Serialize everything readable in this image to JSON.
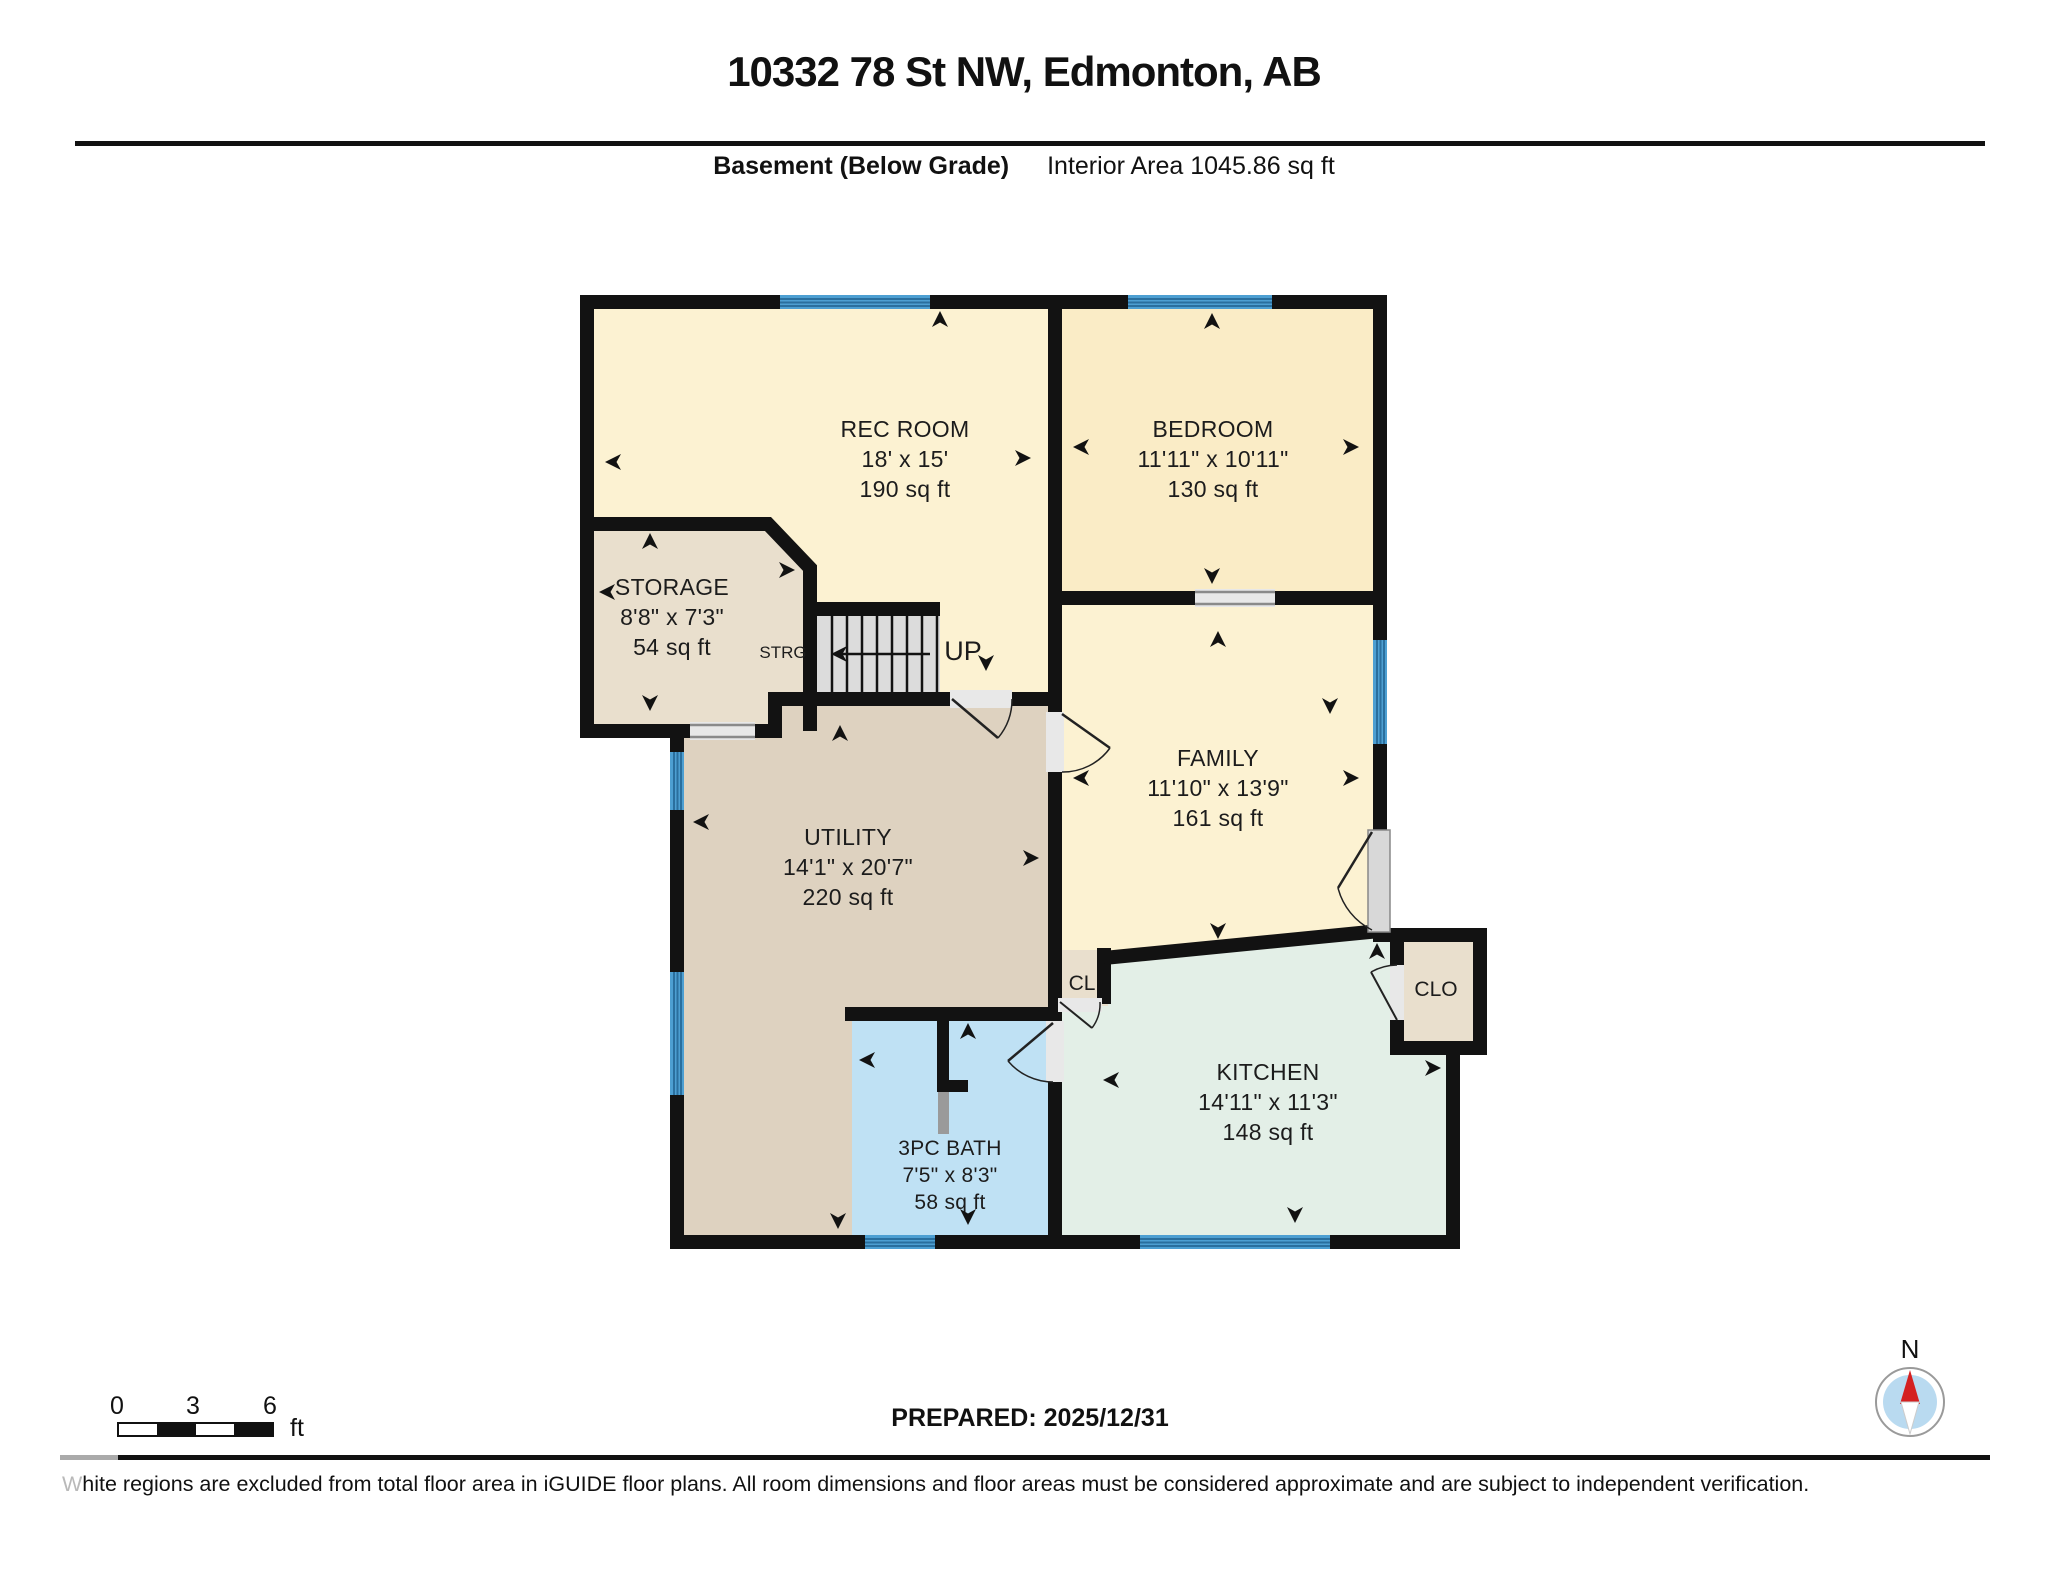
{
  "header": {
    "title": "10332 78 St NW, Edmonton, AB",
    "floor_label": "Basement (Below Grade)",
    "area_label": "Interior Area 1045.86 sq ft"
  },
  "rooms": {
    "rec": {
      "name": "REC ROOM",
      "dims": "18' x 15'",
      "area": "190 sq ft"
    },
    "bedroom": {
      "name": "BEDROOM",
      "dims": "11'11\" x 10'11\"",
      "area": "130 sq ft"
    },
    "storage": {
      "name": "STORAGE",
      "dims": "8'8\" x 7'3\"",
      "area": "54 sq ft"
    },
    "family": {
      "name": "FAMILY",
      "dims": "11'10\" x 13'9\"",
      "area": "161 sq ft"
    },
    "utility": {
      "name": "UTILITY",
      "dims": "14'1\" x 20'7\"",
      "area": "220 sq ft"
    },
    "bath": {
      "name": "3PC BATH",
      "dims": "7'5\" x 8'3\"",
      "area": "58 sq ft"
    },
    "kitchen": {
      "name": "KITCHEN",
      "dims": "14'11\" x 11'3\"",
      "area": "148 sq ft"
    },
    "closet_cl": "CL",
    "closet_clo": "CLO",
    "strg": "STRG",
    "stairs_up": "UP"
  },
  "scale_bar": {
    "labels": [
      "0",
      "3",
      "6"
    ],
    "unit": "ft"
  },
  "footer": {
    "prepared": "PREPARED: 2025/12/31",
    "disclaimer_w": "W",
    "disclaimer_rest": "hite regions are excluded from total floor area in iGUIDE floor plans. All room dimensions and floor areas must be considered approximate and are subject to independent verification."
  },
  "compass": {
    "north_label": "N"
  },
  "colors": {
    "wall": "#121212",
    "room_cream": "#fcf2d2",
    "room_bedroom": "#faecc6",
    "room_tan": "#e9dfcd",
    "room_utility": "#ded2c0",
    "room_bath": "#bfe1f4",
    "room_kitchen": "#e3efe7",
    "window_blue": "#4d9fd2",
    "stairs_gray": "#dcdcdc",
    "needle_red": "#d42020"
  }
}
